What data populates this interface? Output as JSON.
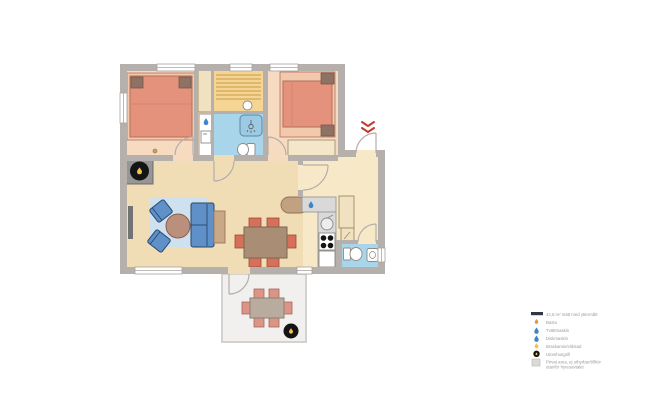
{
  "legend": {
    "items": [
      {
        "icon": "wall-bar-icon",
        "label": "42,5 m² mätt med yttermått"
      },
      {
        "icon": "sauna-flame-icon",
        "label": "Bastu"
      },
      {
        "icon": "water-drop-icon",
        "label": "Tvättmaskin"
      },
      {
        "icon": "water-drop-icon",
        "label": "Diskmaskin"
      },
      {
        "icon": "flame-icon",
        "label": "Braskamin/eldstad"
      },
      {
        "icon": "grill-icon",
        "label": "Utomhusgrill"
      },
      {
        "icon": "private-area-swatch",
        "label": "Privat area, ej uthyrbar/tillhör",
        "label2": "utanför hyresavtalet"
      }
    ]
  },
  "plan": {
    "rooms": [
      "bedroom-1",
      "closet",
      "sauna",
      "bathroom",
      "bedroom-2",
      "living-room",
      "kitchen",
      "hallway",
      "wc",
      "terrace"
    ],
    "markers": [
      "entrance-chevrons",
      "wood-stove-flame",
      "outdoor-grill-flame",
      "washing-machine-drop",
      "dishwasher-drop"
    ]
  },
  "colors": {
    "wall": "#b5b0ab",
    "floor-bedroom": "#f6dbc1",
    "floor-living": "#f0ddb6",
    "floor-hall": "#f7e9c8",
    "floor-wet": "#a8d5ea",
    "sauna": "#f4d593",
    "sauna-stripe": "#dfb86e",
    "bed-frame": "#f2c9ad",
    "bed": "#e5927c",
    "bed-stroke": "#b3705c",
    "pillow": "#8e7365",
    "blue-sofa": "#5f90c8",
    "blue-sofa-stroke": "#27486f",
    "rug": "#cfe0ee",
    "table-round": "#ba8f7c",
    "table-stroke": "#8a614e",
    "side-table": "#c9a887",
    "dining-table": "#aa8d75",
    "chair": "#d5705b",
    "chair-stroke": "#9e4936",
    "counter": "#d9d9d9",
    "counter-stroke": "#999999",
    "cabinet": "#f0e1c1",
    "cabinet-stroke": "#a08a62",
    "peninsula": "#c2a183",
    "terrace": "#f1f0ee",
    "terrace-stroke": "#d4d2ce",
    "outdoor-table": "#b9ab9d",
    "outdoor-table-stroke": "#8a8075",
    "outdoor-chair": "#db9486",
    "outdoor-chair-stroke": "#a6685c",
    "black": "#141414",
    "flame": "#f2c14e",
    "drop": "#3f86c6",
    "red": "#c23b2e",
    "legend-text": "#9a9a9a",
    "legend-bar": "#2f3744",
    "gray-furn": "#737373"
  }
}
